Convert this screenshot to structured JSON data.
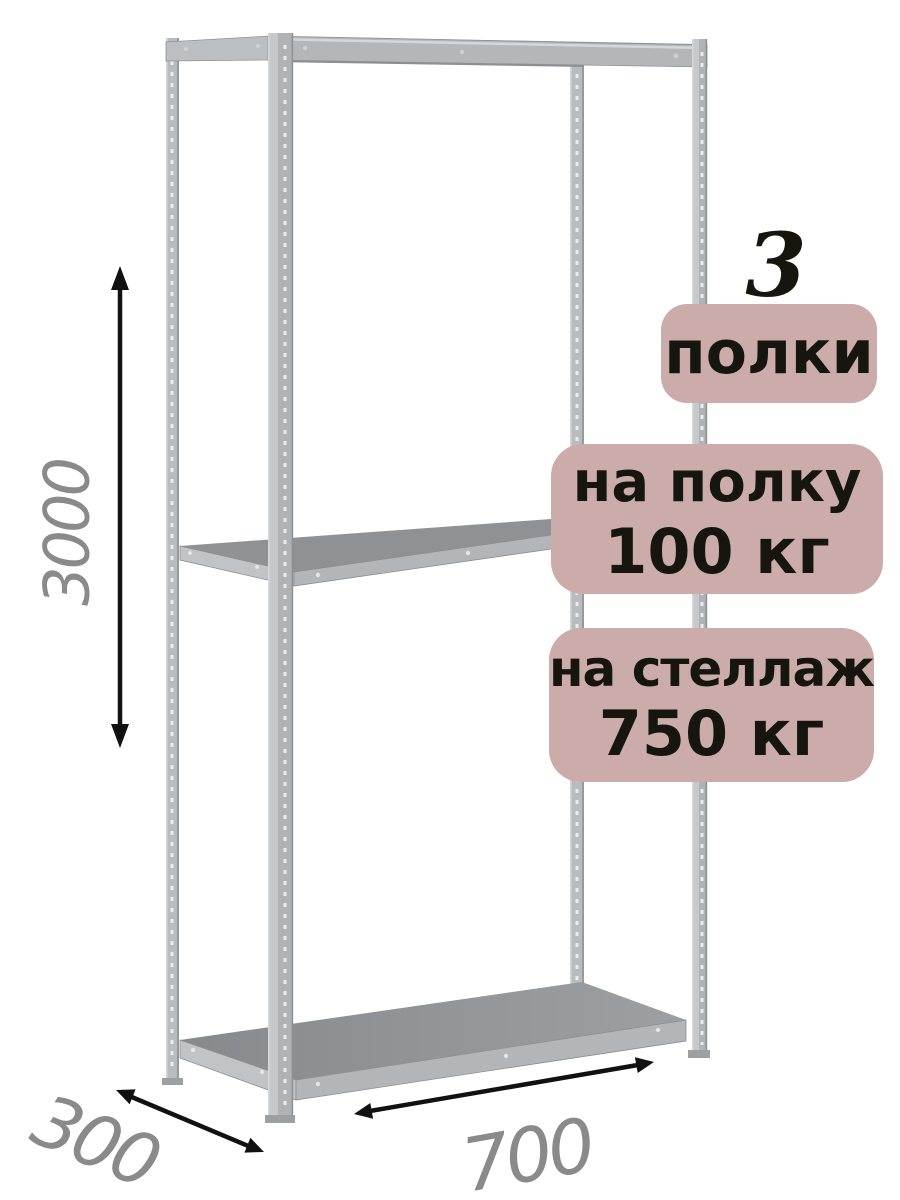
{
  "badges": {
    "shelves": {
      "count": "3",
      "label": "полки"
    },
    "shelf_load": {
      "line1": "на полку",
      "line2": "100 кг"
    },
    "rack_load": {
      "line1": "на стеллаж",
      "line2": "750 кг"
    }
  },
  "dimensions": {
    "height": "3000",
    "depth": "300",
    "width": "700"
  },
  "colors": {
    "background": "#ffffff",
    "badge_background": "#cbacaa",
    "badge_text": "#16160f",
    "dimension_text": "#8a8a8a",
    "dimension_arrow": "#111111",
    "metal_light": "#c1c4c6",
    "metal_mid": "#b3b6b9",
    "metal_dark": "#8f9295"
  }
}
